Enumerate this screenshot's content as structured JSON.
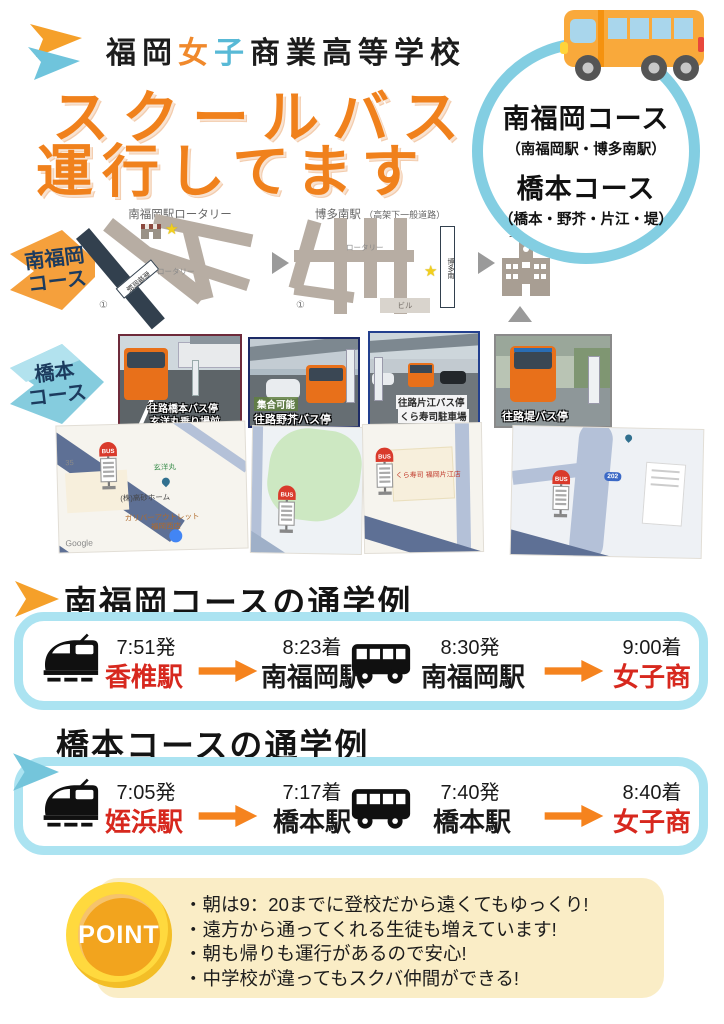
{
  "header": {
    "school_name": {
      "p1": "福岡",
      "p2": "女",
      "p3": "子",
      "p4": "商業高等学校"
    },
    "title_line1": "スクールバス",
    "title_line2": "運行してます"
  },
  "badge": {
    "course1_name": "南福岡コース",
    "course1_stops": "（南福岡駅・博多南駅）",
    "course2_name": "橋本コース",
    "course2_stops": "（橋本・野芥・片江・堤）"
  },
  "minami_row": {
    "label_l1": "南福岡",
    "label_l2": "コース",
    "mapA": {
      "title": "南福岡駅ロータリー",
      "station": "南福岡駅",
      "rotary": "ロータリー",
      "circle1": "①"
    },
    "mapB": {
      "title": "博多南駅",
      "title_note": "（高架下一般道路）",
      "station": "博多南",
      "rotary": "ロータリー",
      "bldg": "ビル",
      "circle1": "①"
    },
    "school_label": "女子商"
  },
  "hashimoto_row": {
    "label_l1": "橋本",
    "label_l2": "コース",
    "photos": [
      {
        "line1": "往路橋本バス停",
        "line2": "玄洋丸乗り場前"
      },
      {
        "line1": "集合可能",
        "line2": "往路野芥バス停"
      },
      {
        "line1": "往路片江バス停",
        "line2": "くら寿司駐車場"
      },
      {
        "line1": "往路堤バス停",
        "line2": ""
      }
    ],
    "maps": [
      {
        "route": "35",
        "label1": "玄洋丸",
        "label2": "(株)高砂ホーム",
        "label3": "ガリバーアウトレット",
        "label4": "福岡西店",
        "watermark": "Google"
      },
      {},
      {
        "label1": "くら寿司 福岡片江店"
      },
      {
        "route": "202"
      }
    ]
  },
  "journey1": {
    "heading": "南福岡コースの通学例",
    "seg1": {
      "dep_time": "7:51発",
      "dep_name": "香椎駅",
      "arr_time": "8:23着",
      "arr_name": "南福岡駅"
    },
    "seg2": {
      "dep_time": "8:30発",
      "dep_name": "南福岡駅",
      "arr_time": "9:00着",
      "arr_name": "女子商"
    }
  },
  "journey2": {
    "heading": "橋本コースの通学例",
    "seg1": {
      "dep_time": "7:05発",
      "dep_name": "姪浜駅",
      "arr_time": "7:17着",
      "arr_name": "橋本駅"
    },
    "seg2": {
      "dep_time": "7:40発",
      "dep_name": "橋本駅",
      "arr_time": "8:40着",
      "arr_name": "女子商"
    }
  },
  "point": {
    "badge": "POINT",
    "bullets": [
      "・朝は9：20までに登校だから遠くてもゆっくり!",
      "・遠方から通ってくれる生徒も増えています!",
      "・朝も帰りも運行があるので安心!",
      "・中学校が違ってもスクバ仲間ができる!"
    ]
  },
  "icons": {
    "star": "★",
    "bus_sign": "BUS"
  },
  "colors": {
    "title_orange": "#f0811c",
    "circle_blue": "#83cee2",
    "label_navy": "#1c3b5e",
    "flag_orange": "#f5a03c",
    "flag_blue": "#85ccde",
    "journey_border_blue": "#abe3f1",
    "station_red": "#d7281e",
    "arrow_orange": "#f5831e",
    "point_cream": "#faedc6",
    "point_yellow": "#ffd93e",
    "point_orange": "#f2a41e"
  }
}
